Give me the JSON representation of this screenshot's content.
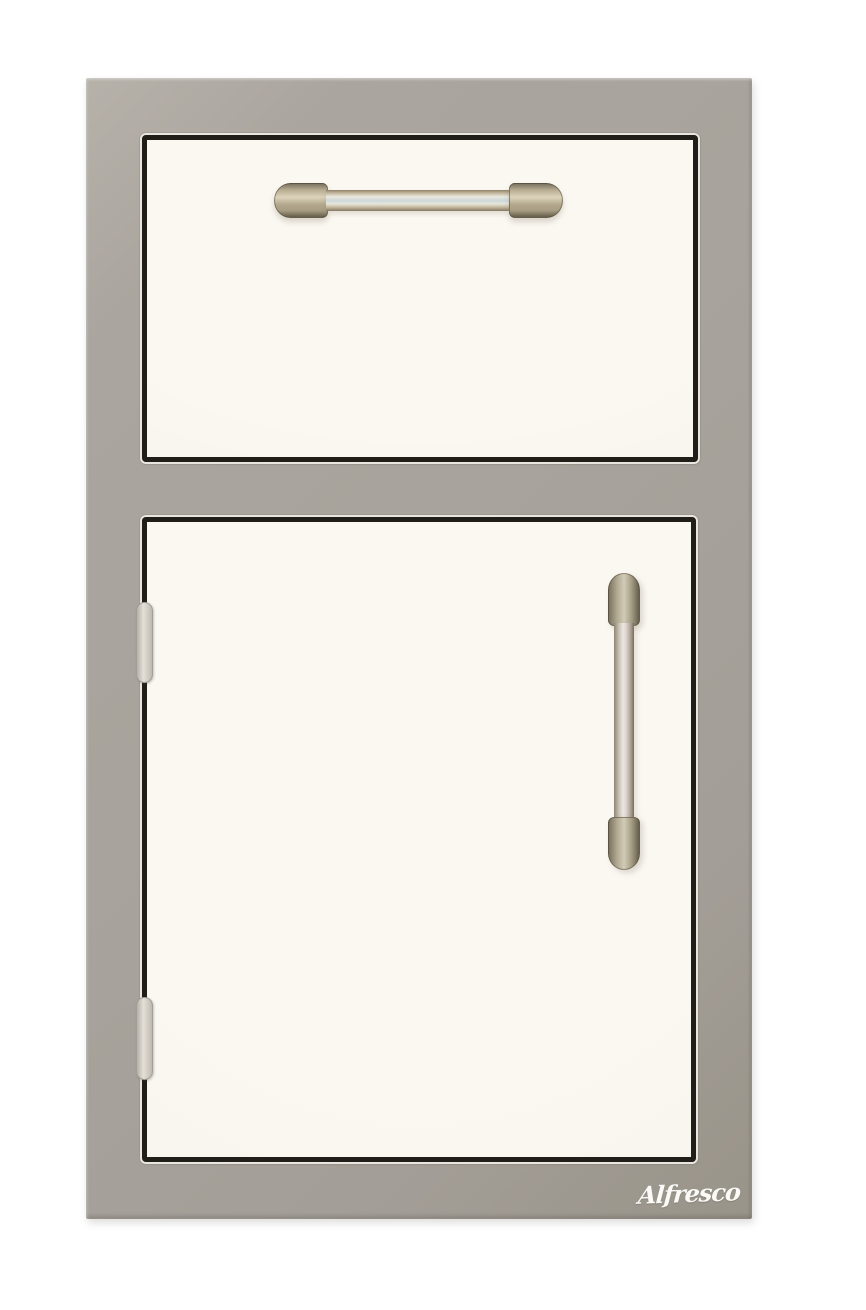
{
  "logo": {
    "text": "Alfresco"
  },
  "colors": {
    "background": "#ffffff",
    "frame": "#a8a39c",
    "frame-highlight": "#c6c2ba",
    "frame-shadow": "#948f87",
    "panel": "#f8f5ee",
    "panel-border": "#211e19",
    "gap-highlight": "#e9e6df",
    "handle-base": "#b3a88e",
    "handle-dark": "#7c7460",
    "handle-highlight": "#ece9de",
    "handle-sheen": "#ccd8da",
    "hinge": "#d9d5cd",
    "hinge-edge": "#a29e96",
    "logo-text": "#fbfaf6"
  }
}
